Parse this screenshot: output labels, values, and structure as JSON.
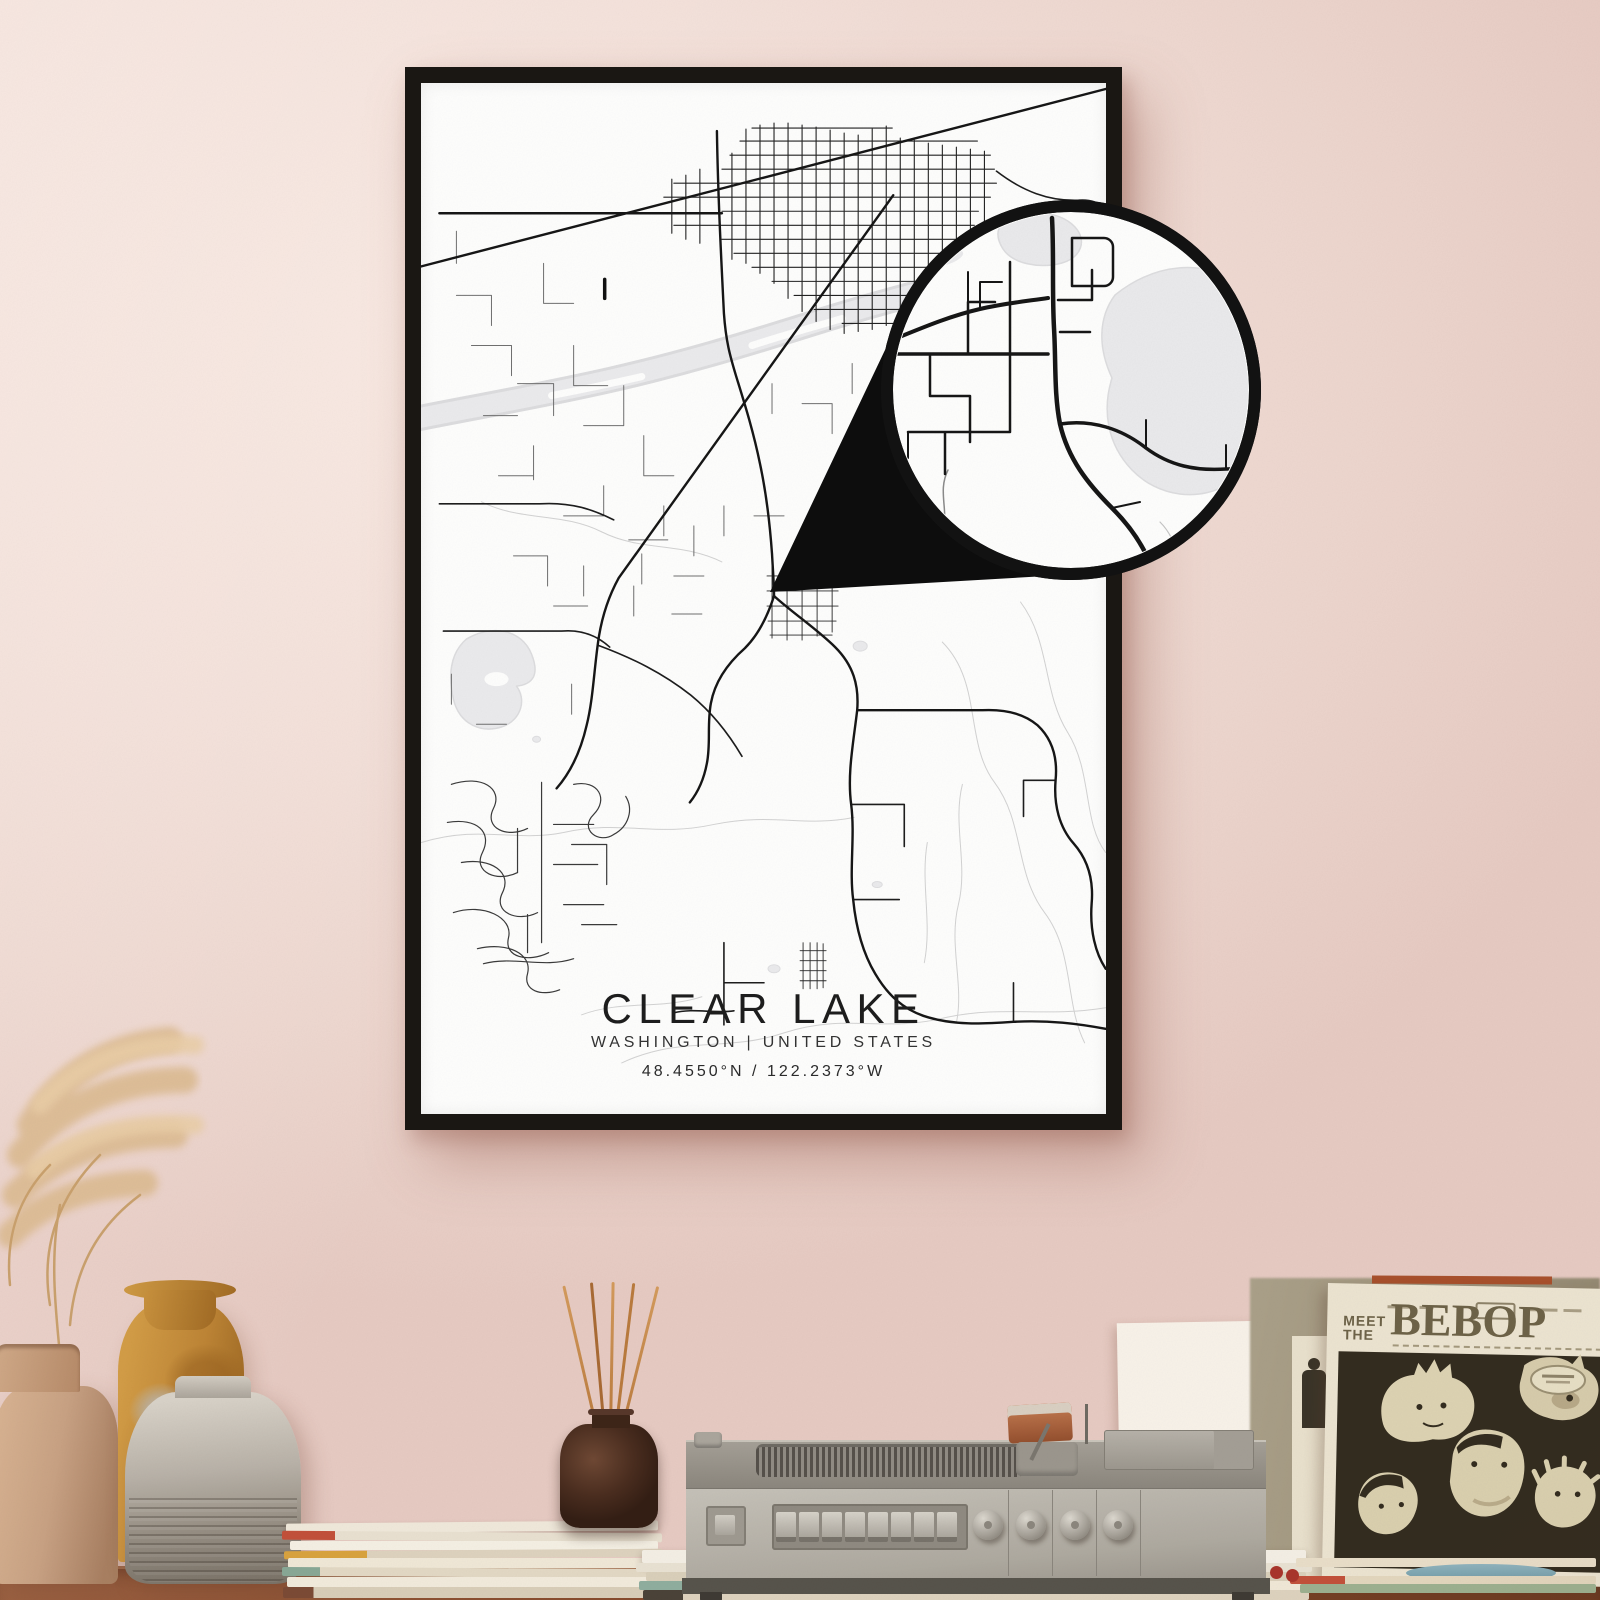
{
  "poster": {
    "title": "CLEAR LAKE",
    "subtitle": "WASHINGTON | UNITED STATES",
    "coordinates": "48.4550°N / 122.2373°W"
  },
  "album": {
    "word_meet": "MEET",
    "word_the": "THE",
    "title": "BEBOP"
  },
  "colors": {
    "wall_pink": "#efd9d2",
    "frame_black": "#1a1713",
    "map_road": "#1a1a1a",
    "map_water": "#e9e9eb",
    "magnifier_border": "#121212",
    "table_wood": "#8a4e30",
    "sleeve_cream": "#ebe3d0",
    "sleeve_ink": "#6d6247",
    "artwork_dark": "#332c1f",
    "player_gray": "#b5b0a7",
    "diffuser_brown": "#46291c",
    "reed_orange": "#c98648",
    "vase_tan": "#c8a184",
    "vase_amber": "#bd8435",
    "vase_gray": "#b2aba1",
    "pampas_tan": "#dcbb92"
  }
}
